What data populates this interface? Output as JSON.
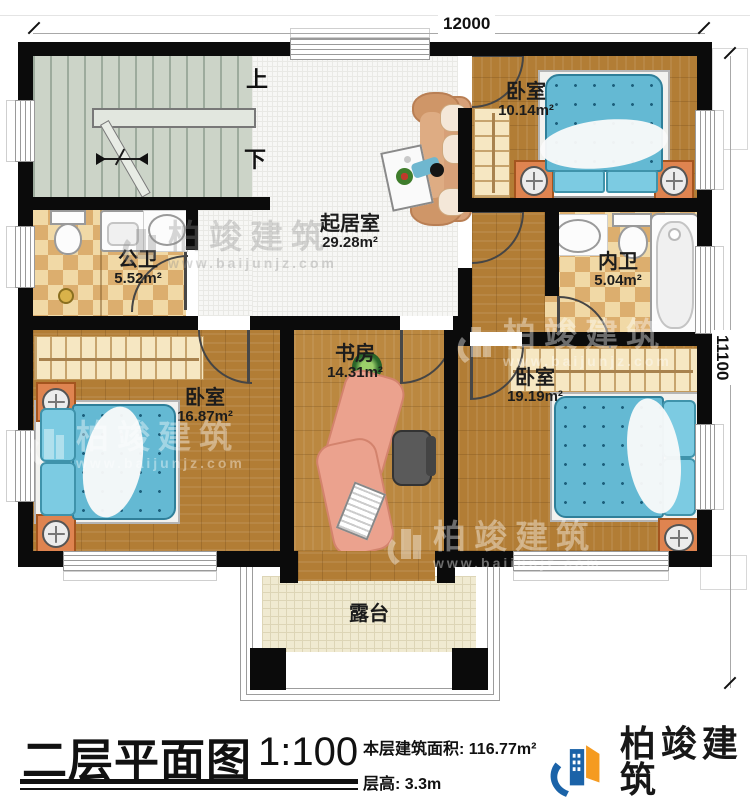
{
  "plan": {
    "dimension_top": "12000",
    "dimension_right": "11100",
    "stair_up_label": "上",
    "stair_down_label": "下",
    "rooms": {
      "bedroom_top": {
        "name": "卧室",
        "area": "10.14m²"
      },
      "living": {
        "name": "起居室",
        "area": "29.28m²"
      },
      "public_bath": {
        "name": "公卫",
        "area": "5.52m²"
      },
      "inner_bath": {
        "name": "内卫",
        "area": "5.04m²"
      },
      "bedroom_left": {
        "name": "卧室",
        "area": "16.87m²"
      },
      "study": {
        "name": "书房",
        "area": "14.31m²"
      },
      "bedroom_right": {
        "name": "卧室",
        "area": "19.19m²"
      },
      "terrace": {
        "name": "露台"
      }
    },
    "icons": [
      "stairs",
      "toilet",
      "washing-machine",
      "sink",
      "floor-drain",
      "sofa",
      "coffee-table",
      "person",
      "wardrobe",
      "bed",
      "nightstand",
      "bathtub",
      "desk",
      "office-chair",
      "keyboard",
      "plant",
      "column",
      "window",
      "door-arc"
    ]
  },
  "watermark": {
    "name": "柏竣建筑",
    "url": "www.baijunjz.com"
  },
  "titleblock": {
    "title": "二层平面图",
    "scale": "1:100",
    "area_label": "本层建筑面积: ",
    "area_value": "116.77m²",
    "floor_height_label": "层高: ",
    "floor_height_value": "3.3m"
  },
  "brand": {
    "name": "柏竣建筑",
    "url": "www.baijunjz.com",
    "blue": "#1b63a8",
    "orange": "#f59b20"
  }
}
